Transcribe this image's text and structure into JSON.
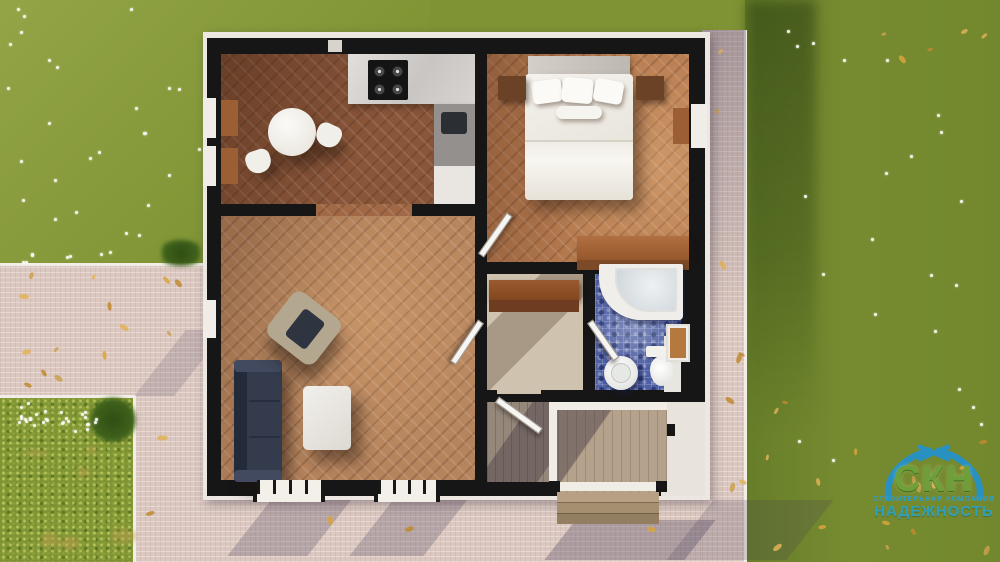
{
  "canvas": {
    "width": 1000,
    "height": 562
  },
  "watermark": {
    "icon": "roof-swoosh-icon",
    "company_abbr": "СКН",
    "company_caption": "СТРОИТЕЛЬНАЯ КОМПАНИЯ",
    "company_name": "НАДЕЖНОСТЬ",
    "colors": {
      "roof": "#2191d2",
      "abbr": "#6da23c",
      "caption": "#28a0d8",
      "name": "#2aa3c6"
    }
  },
  "scene": {
    "type": "top-down 3D render of a single-storey house floor plan",
    "rooms": [
      "kitchen-dining-room",
      "living-room",
      "bedroom",
      "hallway",
      "bathroom",
      "entry-vestibule",
      "porch"
    ],
    "objects": [
      "dining-table",
      "dining-chairs",
      "stove",
      "kitchen-counter",
      "kitchen-sink",
      "double-bed",
      "nightstands",
      "dresser-desk",
      "sofa",
      "armchair",
      "coffee-table",
      "wardrobe-console",
      "corner-bathtub",
      "pedestal-sink",
      "toilet",
      "open-doors",
      "windows",
      "porch-steps",
      "garden-bed",
      "walkway",
      "lawn",
      "fallen-leaves",
      "white-flowers"
    ],
    "palette": {
      "grass": "#7f9334",
      "grass_shadow": "#4c6a1d",
      "pavement": "#dbc8c0",
      "walls": "#161616",
      "house_band": "#ece7e0",
      "kitchen_floor": "#8a5639",
      "living_floor": "#b5835c",
      "bedroom_floor": "#b87c50",
      "hall_floor": "#cfc2ae",
      "bath_tile": "#4e5fa3",
      "sofa": "#333b4d",
      "armchair": "#b3a88f",
      "wood_furniture": "#a4663a",
      "leaves": "#d9a33c"
    }
  }
}
